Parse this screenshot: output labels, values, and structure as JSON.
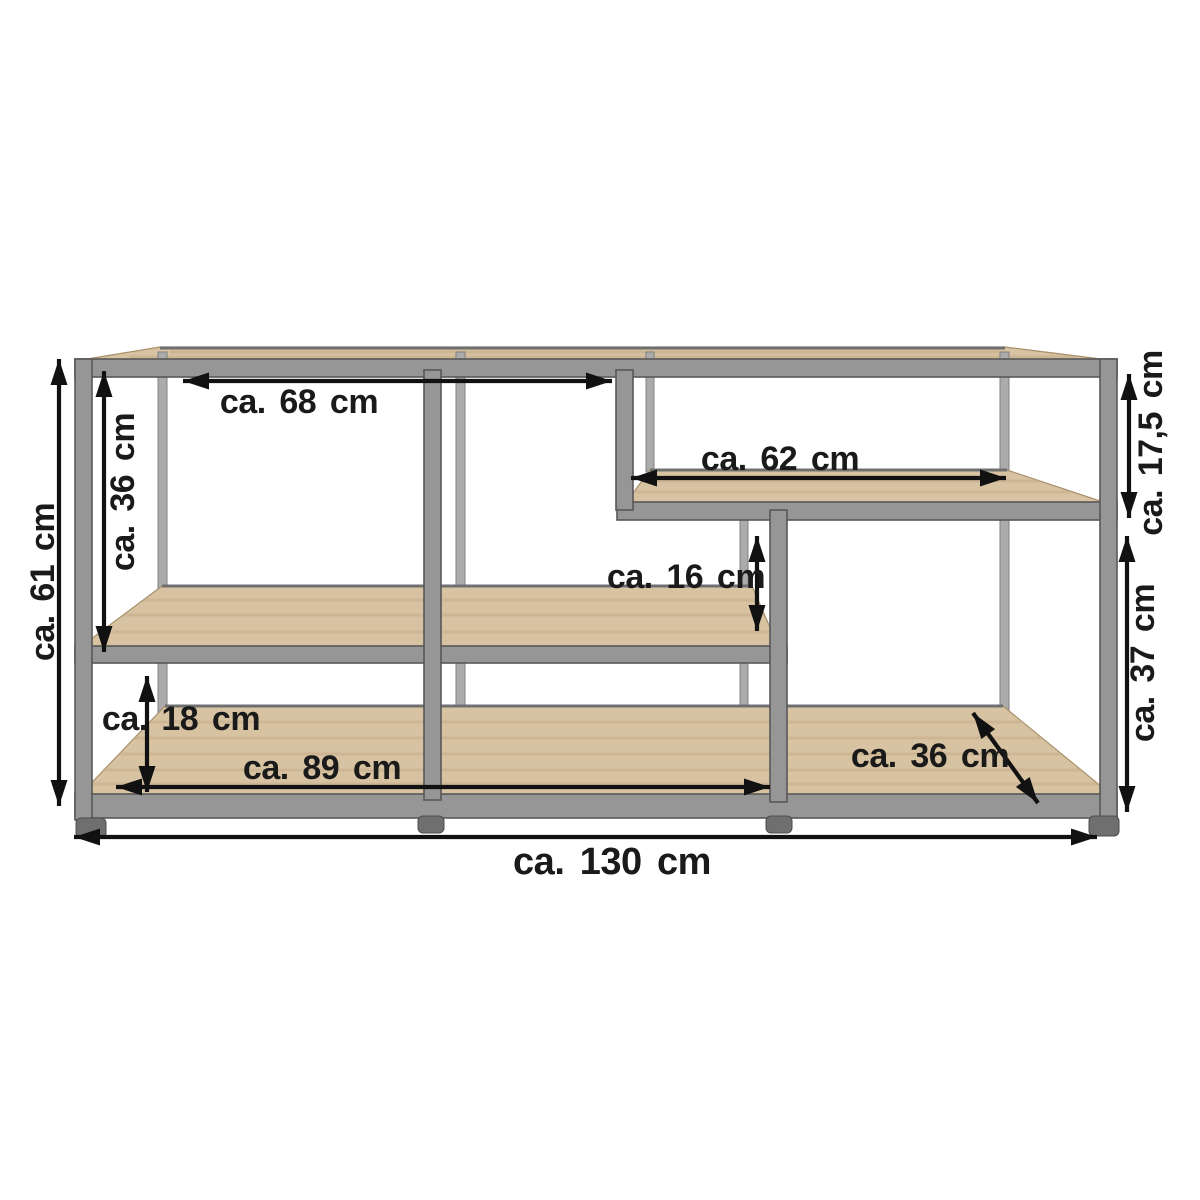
{
  "diagram": {
    "type": "furniture-dimension-diagram",
    "product": "Industrial shelf sideboard with grey metal frame and wooden shelves",
    "units": "cm",
    "colors": {
      "frame": "#969696",
      "frame_dark": "#585858",
      "frame_back": "#ababab",
      "frame_back_edge": "#828282",
      "wood": "#d7c3a2",
      "wood_streak": "#c2aa85",
      "wood_edge": "#a8906c",
      "arrow": "#111111",
      "label": "#1a1a1a",
      "page_bg": "#ffffff"
    },
    "measurements": {
      "total_width": "ca. 130 cm",
      "total_height": "ca. 61 cm",
      "upper_opening_width": "ca. 68 cm",
      "upper_left_height": "ca. 36 cm",
      "right_shelf_width": "ca. 62 cm",
      "upper_right_height": "ca. 17,5 cm",
      "middle_gap_height": "ca. 16 cm",
      "lower_right_height": "ca. 37 cm",
      "lower_left_height": "ca. 18 cm",
      "lower_shelf_width": "ca. 89 cm",
      "shelf_depth": "ca. 36 cm"
    }
  }
}
